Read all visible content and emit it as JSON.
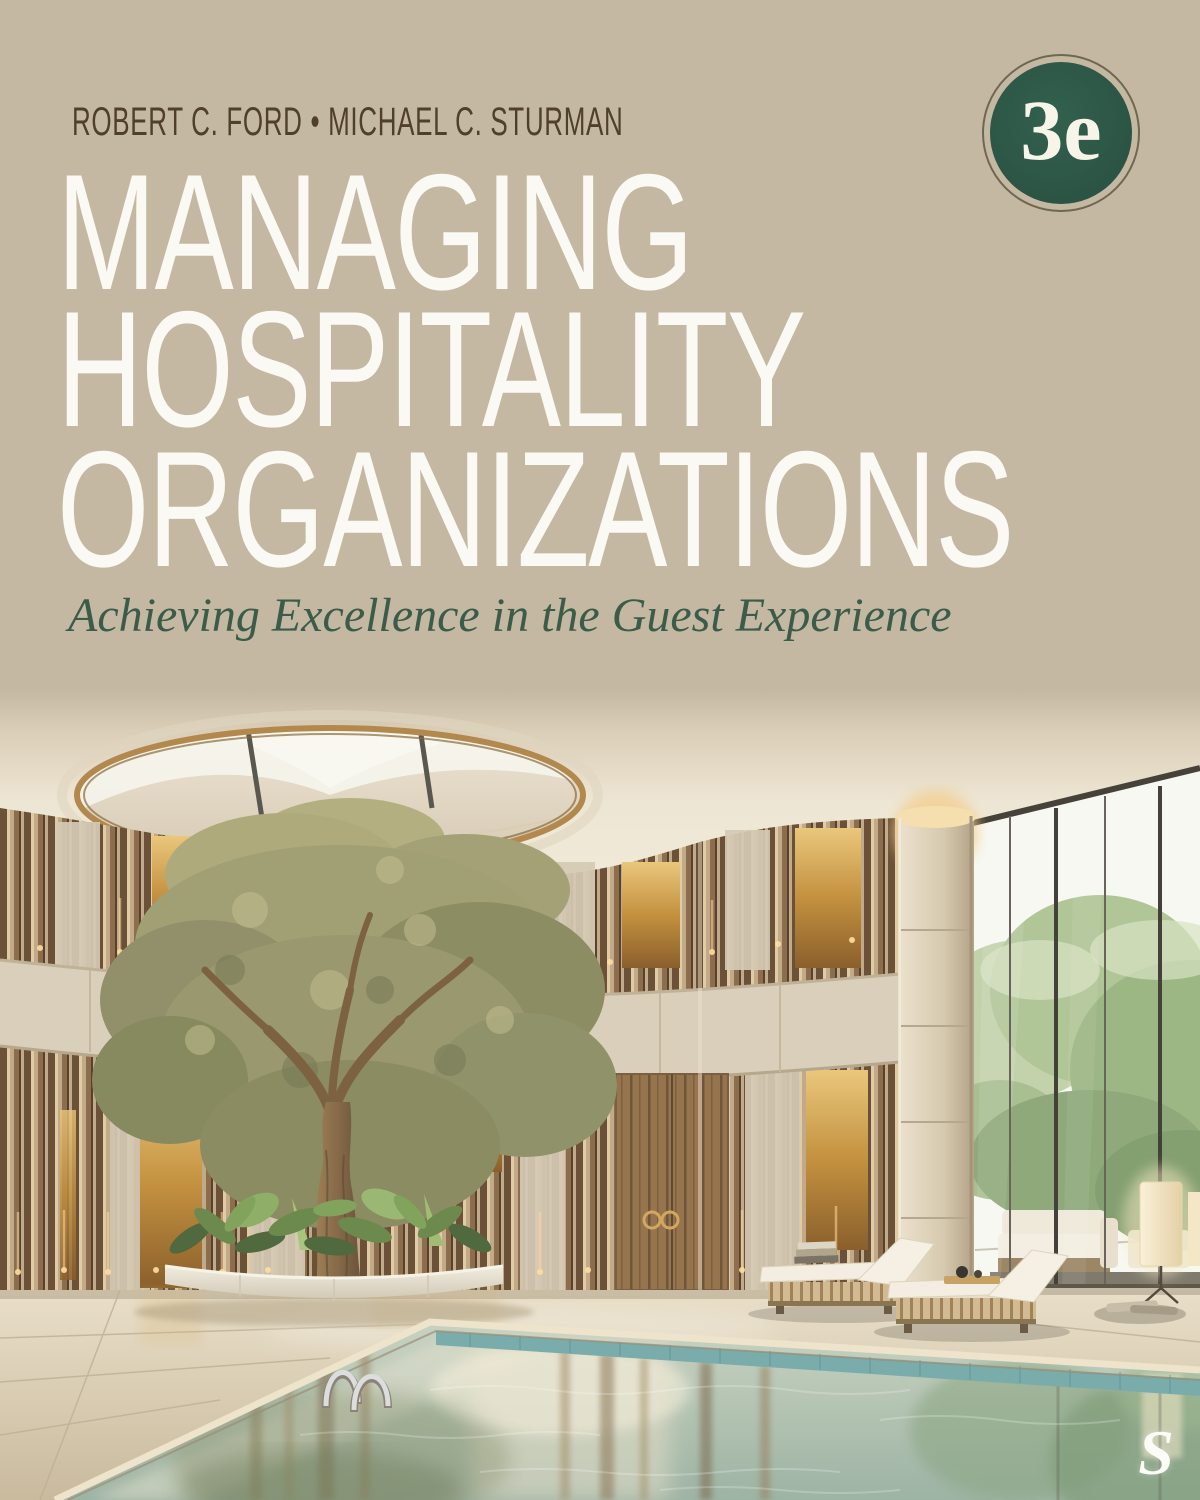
{
  "cover": {
    "authors": "ROBERT C. FORD • MICHAEL C. STURMAN",
    "title": {
      "lines": [
        "MANAGING",
        "HOSPITALITY",
        "ORGANIZATIONS"
      ]
    },
    "subtitle": "Achieving Excellence in the Guest Experience",
    "edition_badge": "3e",
    "publisher_logo": "S",
    "colors": {
      "background_tan": "#c5b8a2",
      "title_text": "#fbf9f3",
      "subtitle_green": "#3a5c49",
      "author_brown": "#4f3f2c",
      "badge_green": "#2c5846",
      "badge_ring": "#6e684f",
      "badge_text": "#f7f4ea",
      "ceiling_cream": "#f3ecdb",
      "wood_slat": "#6b5138",
      "gold_accent": "#d1a054",
      "stone_band": "#d9cfba",
      "pool_water": "#aec0b0",
      "pool_tile": "#7bacac",
      "logo_white": "#fcfcf7"
    },
    "photo": {
      "scene": "Indoor hotel pool atrium: olive tree under an oval gold-rimmed skylight, curved bronze slatted walls, travertine column, floor-to-ceiling windows with trees outside, two lounge chairs, floor lamp and reflecting pool with ladder"
    }
  }
}
